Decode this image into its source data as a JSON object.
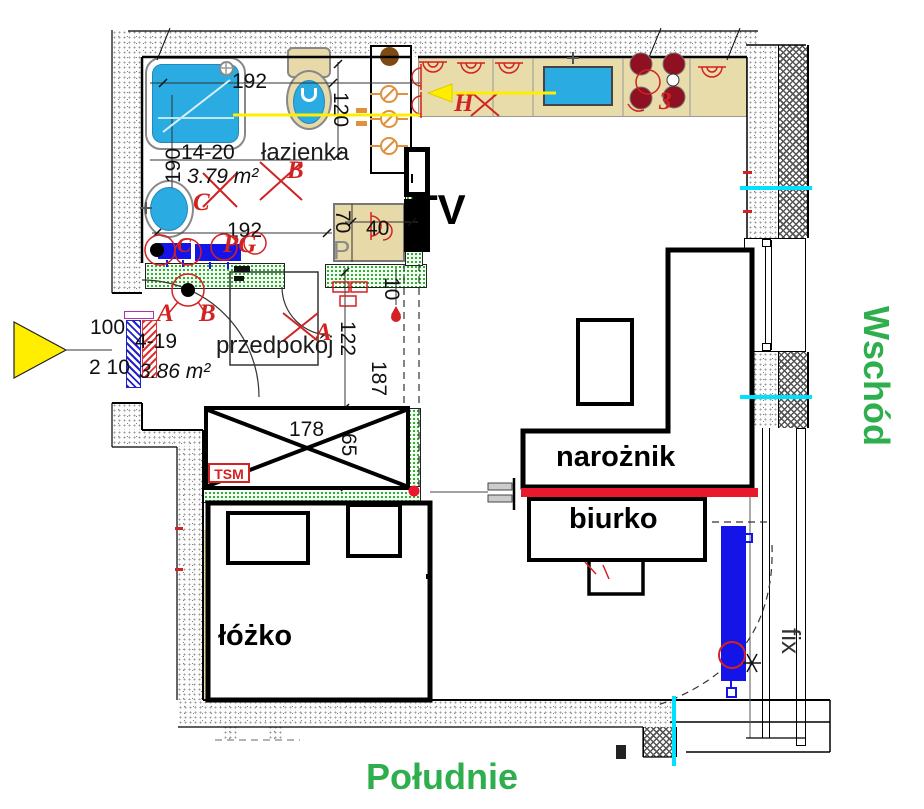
{
  "plan": {
    "rooms": {
      "bathroom": {
        "name": "łazienka",
        "area": "3.79 m²"
      },
      "hallway": {
        "name": "przedpokój",
        "area": "3.86 m²"
      }
    },
    "furniture": {
      "tv": "TV",
      "corner_sofa": "narożnik",
      "desk": "biurko",
      "bed": "łóżko",
      "washing_machine": "P",
      "fixed_window": "fix",
      "wardrobe_tag": "TSM",
      "hob_burner_count": "3"
    },
    "compass": {
      "east": "Wschód",
      "south": "Południe"
    },
    "dimensions": {
      "bathroom_top_width": "192",
      "bathroom_right_height": "120",
      "bathroom_left_height": "190",
      "bathroom_wall_range": "14-20",
      "bathroom_bottom_width": "192",
      "washer_depth": "70",
      "washer_width": "40",
      "entry_wall_range": "4-19",
      "entry_door_width": "100",
      "entry_door_height": "2 10",
      "hall_width": "122",
      "hall_length": "187",
      "partition_thickness": "10",
      "wardrobe_width": "178",
      "wardrobe_depth": "65"
    },
    "markers": {
      "bathroom_b": "B",
      "bathroom_c": "C",
      "bathroom_c2": "C",
      "bathroom_pg": "PG",
      "hallway_a1": "A",
      "hallway_b": "B",
      "hallway_a2": "A",
      "kitchen_h": "H"
    },
    "colors": {
      "compass_green": "#2fae4e",
      "marker_red": "#d22222",
      "accent_red_line": "#e8192c",
      "radiator_blue": "#1414e8",
      "fixture_blue": "#2aabe2",
      "counter_tan": "#e9dcab",
      "burner_maroon": "#8e1021",
      "highlight_yellow": "#ffee00",
      "axis_cyan": "#00e0ff",
      "new_wall_green": "#1ea51e",
      "valve_orange": "#e0913d",
      "shaft_brown": "#7c4a12"
    }
  }
}
